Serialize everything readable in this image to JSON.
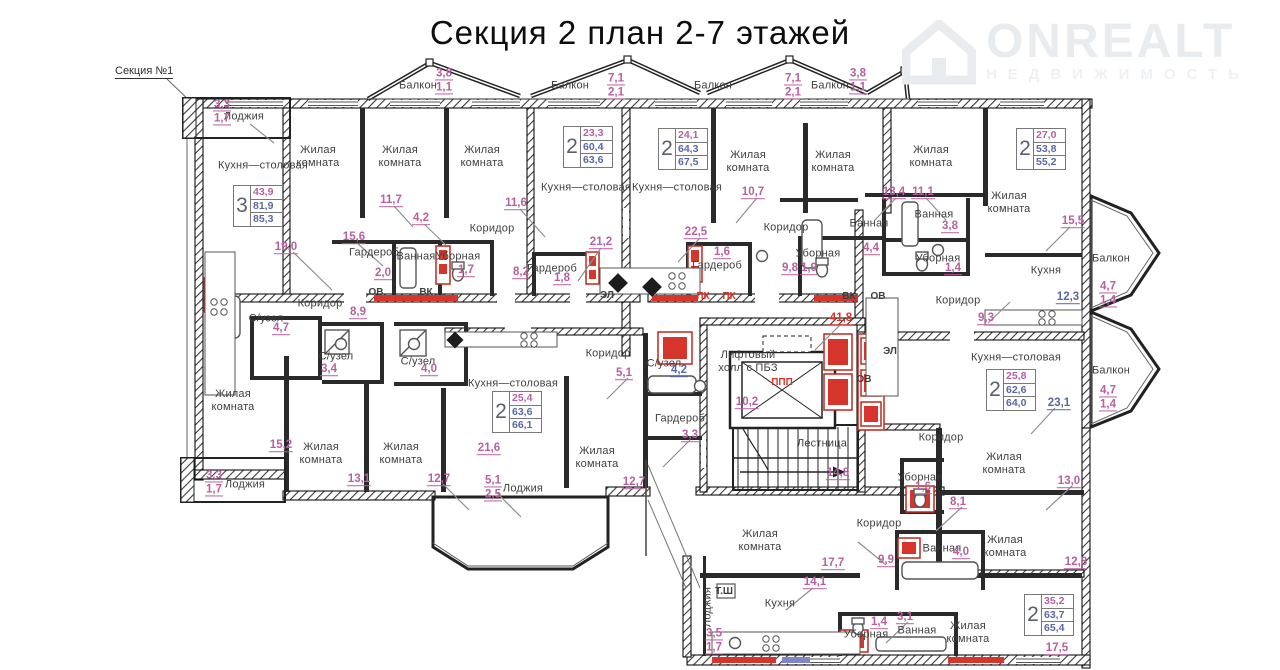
{
  "header": {
    "title": "Секция 2 план 2-7 этажей",
    "section_ref": "Секция №1",
    "logo": {
      "brand": "ONREALT",
      "subtitle": "НЕДВИЖИМОСТЬ",
      "icon": "house-icon",
      "color": "#e9ecef"
    }
  },
  "colors": {
    "area_primary": "#b8609f",
    "area_secondary": "#5868a8",
    "alert_red": "#d6352b",
    "walls": "#1a1a1a",
    "room_text": "#3f3f3f",
    "leader": "#8f8f8f"
  },
  "plan": {
    "rooms": [
      {
        "t": "Лоджия",
        "x": 244,
        "y": 117
      },
      {
        "t": "Кухня—столовая",
        "x": 263,
        "y": 166
      },
      {
        "t": "Жилая\nкомната",
        "x": 318,
        "y": 157
      },
      {
        "t": "Жилая\nкомната",
        "x": 400,
        "y": 157
      },
      {
        "t": "Жилая\nкомната",
        "x": 482,
        "y": 157
      },
      {
        "t": "Балкон",
        "x": 418,
        "y": 86
      },
      {
        "t": "Балкон",
        "x": 570,
        "y": 86
      },
      {
        "t": "Балкон",
        "x": 713,
        "y": 86
      },
      {
        "t": "Балкон",
        "x": 830,
        "y": 86
      },
      {
        "t": "Кухня—столовая",
        "x": 586,
        "y": 188
      },
      {
        "t": "Кухня—столовая",
        "x": 677,
        "y": 188
      },
      {
        "t": "Жилая\nкомната",
        "x": 748,
        "y": 162
      },
      {
        "t": "Жилая\nкомната",
        "x": 833,
        "y": 162
      },
      {
        "t": "Жилая\nкомната",
        "x": 931,
        "y": 157
      },
      {
        "t": "Жилая\nкомната",
        "x": 1009,
        "y": 203
      },
      {
        "t": "Коридор",
        "x": 492,
        "y": 229
      },
      {
        "t": "Коридор",
        "x": 786,
        "y": 228
      },
      {
        "t": "Гардероб",
        "x": 374,
        "y": 253
      },
      {
        "t": "Ванная",
        "x": 416,
        "y": 257
      },
      {
        "t": "Уборная",
        "x": 458,
        "y": 257
      },
      {
        "t": "Гардероб",
        "x": 552,
        "y": 269
      },
      {
        "t": "Гардероб",
        "x": 717,
        "y": 266
      },
      {
        "t": "Ванная",
        "x": 869,
        "y": 224
      },
      {
        "t": "Уборная",
        "x": 818,
        "y": 254
      },
      {
        "t": "Ванная",
        "x": 934,
        "y": 215
      },
      {
        "t": "Уборная",
        "x": 938,
        "y": 259
      },
      {
        "t": "Кухня",
        "x": 1046,
        "y": 271
      },
      {
        "t": "Коридор",
        "x": 958,
        "y": 301
      },
      {
        "t": "Балкон",
        "x": 1111,
        "y": 259
      },
      {
        "t": "Балкон",
        "x": 1111,
        "y": 371
      },
      {
        "t": "Коридор",
        "x": 320,
        "y": 304
      },
      {
        "t": "С/узел",
        "x": 266,
        "y": 319
      },
      {
        "t": "С/узел",
        "x": 336,
        "y": 357
      },
      {
        "t": "С/узел",
        "x": 418,
        "y": 362
      },
      {
        "t": "Жилая\nкомната",
        "x": 233,
        "y": 401
      },
      {
        "t": "Жилая\nкомната",
        "x": 321,
        "y": 454
      },
      {
        "t": "Жилая\nкомната",
        "x": 401,
        "y": 454
      },
      {
        "t": "Лоджия",
        "x": 245,
        "y": 485
      },
      {
        "t": "Кухня—столовая",
        "x": 513,
        "y": 384
      },
      {
        "t": "Жилая\nкомната",
        "x": 597,
        "y": 458
      },
      {
        "t": "Коридор",
        "x": 608,
        "y": 354
      },
      {
        "t": "С/узел",
        "x": 664,
        "y": 364
      },
      {
        "t": "Гардероб",
        "x": 680,
        "y": 419
      },
      {
        "t": "Лоджия",
        "x": 523,
        "y": 489
      },
      {
        "t": "Лифтовый\nхолл с ПБЗ",
        "x": 748,
        "y": 362
      },
      {
        "t": "Лестница",
        "x": 822,
        "y": 444
      },
      {
        "t": "Коридор",
        "x": 941,
        "y": 438
      },
      {
        "t": "Кухня—столовая",
        "x": 1016,
        "y": 358
      },
      {
        "t": "Уборная",
        "x": 920,
        "y": 478
      },
      {
        "t": "Жилая\nкомната",
        "x": 1004,
        "y": 464
      },
      {
        "t": "Жилая\nкомната",
        "x": 1005,
        "y": 547
      },
      {
        "t": "Ванная",
        "x": 942,
        "y": 549
      },
      {
        "t": "Коридор",
        "x": 879,
        "y": 524
      },
      {
        "t": "Жилая\nкомната",
        "x": 760,
        "y": 541
      },
      {
        "t": "Кухня",
        "x": 780,
        "y": 604
      },
      {
        "t": "Лоджия",
        "x": 708,
        "y": 607,
        "vert": true
      },
      {
        "t": "Уборная",
        "x": 866,
        "y": 635
      },
      {
        "t": "Ванная",
        "x": 917,
        "y": 631
      },
      {
        "t": "Жилая\nкомната",
        "x": 968,
        "y": 633
      }
    ],
    "areas": [
      {
        "v": "3,3",
        "v2": "1,7",
        "x": 222,
        "y": 112
      },
      {
        "v": "3,8",
        "v2": "1,1",
        "x": 444,
        "y": 81
      },
      {
        "v": "7,1",
        "v2": "2,1",
        "x": 616,
        "y": 86
      },
      {
        "v": "7,1",
        "v2": "2,1",
        "x": 793,
        "y": 86
      },
      {
        "v": "3,8",
        "v2": "1,1",
        "x": 858,
        "y": 81
      },
      {
        "v": "19,0",
        "x": 286,
        "y": 248
      },
      {
        "v": "15,6",
        "x": 354,
        "y": 238
      },
      {
        "v": "11,7",
        "x": 391,
        "y": 201
      },
      {
        "v": "4,2",
        "x": 421,
        "y": 219
      },
      {
        "v": "2,0",
        "x": 383,
        "y": 274
      },
      {
        "v": "1,7",
        "x": 466,
        "y": 271
      },
      {
        "v": "11,6",
        "x": 516,
        "y": 204
      },
      {
        "v": "8,2",
        "x": 521,
        "y": 273
      },
      {
        "v": "1,8",
        "x": 562,
        "y": 279
      },
      {
        "v": "21,2",
        "x": 601,
        "y": 243
      },
      {
        "v": "22,5",
        "x": 696,
        "y": 233
      },
      {
        "v": "1,6",
        "x": 722,
        "y": 253
      },
      {
        "v": "10,7",
        "x": 753,
        "y": 193
      },
      {
        "v": "13,4",
        "x": 894,
        "y": 193
      },
      {
        "v": "11,1",
        "x": 923,
        "y": 193
      },
      {
        "v": "4,4",
        "x": 871,
        "y": 249
      },
      {
        "v": "9,8",
        "x": 790,
        "y": 269
      },
      {
        "v": "1,9",
        "x": 809,
        "y": 269
      },
      {
        "v": "15,5",
        "x": 1073,
        "y": 222
      },
      {
        "v": "3,8",
        "x": 950,
        "y": 227
      },
      {
        "v": "1,4",
        "x": 953,
        "y": 269
      },
      {
        "v": "12,3",
        "c": "b",
        "x": 1068,
        "y": 298
      },
      {
        "v": "9,3",
        "x": 986,
        "y": 319
      },
      {
        "v": "4,7",
        "v2": "1,4",
        "x": 1108,
        "y": 294
      },
      {
        "v": "4,7",
        "v2": "1,4",
        "x": 1108,
        "y": 398
      },
      {
        "v": "8,9",
        "x": 358,
        "y": 313
      },
      {
        "v": "4,7",
        "x": 281,
        "y": 329
      },
      {
        "v": "3,4",
        "x": 329,
        "y": 370
      },
      {
        "v": "4,0",
        "x": 429,
        "y": 370
      },
      {
        "v": "15,2",
        "x": 281,
        "y": 446
      },
      {
        "v": "13,1",
        "x": 359,
        "y": 480
      },
      {
        "v": "12,7",
        "x": 439,
        "y": 480
      },
      {
        "v": "3,3",
        "v2": "1,7",
        "x": 214,
        "y": 483
      },
      {
        "v": "21,6",
        "x": 489,
        "y": 449
      },
      {
        "v": "5,1",
        "v2": "2,5",
        "x": 493,
        "y": 488
      },
      {
        "v": "5,1",
        "x": 624,
        "y": 374
      },
      {
        "v": "4,2",
        "c": "b",
        "x": 679,
        "y": 371
      },
      {
        "v": "3,3",
        "x": 690,
        "y": 436
      },
      {
        "v": "12,7",
        "x": 634,
        "y": 483
      },
      {
        "v": "10,2",
        "x": 747,
        "y": 403
      },
      {
        "v": "41,8",
        "c": "r",
        "x": 841,
        "y": 319
      },
      {
        "v": "14,8",
        "x": 838,
        "y": 474
      },
      {
        "v": "23,1",
        "c": "b",
        "x": 1059,
        "y": 404
      },
      {
        "v": "1,6",
        "x": 923,
        "y": 488
      },
      {
        "v": "8,1",
        "x": 958,
        "y": 503
      },
      {
        "v": "9,9",
        "x": 886,
        "y": 561
      },
      {
        "v": "4,0",
        "x": 961,
        "y": 553
      },
      {
        "v": "17,7",
        "x": 833,
        "y": 564
      },
      {
        "v": "14,1",
        "x": 815,
        "y": 583
      },
      {
        "v": "3,5",
        "v2": "1,7",
        "x": 714,
        "y": 641
      },
      {
        "v": "1,4",
        "x": 879,
        "y": 623
      },
      {
        "v": "3,1",
        "x": 905,
        "y": 618
      },
      {
        "v": "13,0",
        "x": 1069,
        "y": 482
      },
      {
        "v": "12,8",
        "x": 1076,
        "y": 563
      },
      {
        "v": "17,5",
        "x": 1057,
        "y": 649
      }
    ],
    "ducts": [
      {
        "t": "ОВ",
        "x": 376,
        "y": 293
      },
      {
        "t": "ВК",
        "x": 426,
        "y": 293
      },
      {
        "t": "ЭЛ",
        "x": 607,
        "y": 296
      },
      {
        "t": "ПК",
        "c": "r",
        "x": 703,
        "y": 297
      },
      {
        "t": "ПК",
        "c": "r",
        "x": 729,
        "y": 297
      },
      {
        "t": "ВК",
        "x": 849,
        "y": 297
      },
      {
        "t": "ОВ",
        "x": 878,
        "y": 297
      },
      {
        "t": "ОВ",
        "x": 864,
        "y": 380
      },
      {
        "t": "ЭЛ",
        "x": 890,
        "y": 352
      },
      {
        "t": "ППП",
        "c": "r",
        "x": 782,
        "y": 383
      },
      {
        "t": "Т.Ш",
        "x": 724,
        "y": 592
      }
    ],
    "apartment_tables": [
      {
        "x": 233,
        "y": 185,
        "rooms": "3",
        "r1": "43,9",
        "r2": "81,9",
        "r3": "85,3"
      },
      {
        "x": 563,
        "y": 126,
        "rooms": "2",
        "r1": "23,3",
        "r2": "60,4",
        "r3": "63,6"
      },
      {
        "x": 658,
        "y": 128,
        "rooms": "2",
        "r1": "24,1",
        "r2": "64,3",
        "r3": "67,5"
      },
      {
        "x": 1016,
        "y": 128,
        "rooms": "2",
        "r1": "27,0",
        "r2": "53,8",
        "r3": "55,2"
      },
      {
        "x": 986,
        "y": 369,
        "rooms": "2",
        "r1": "25,8",
        "r2": "62,6",
        "r3": "64,0"
      },
      {
        "x": 492,
        "y": 391,
        "rooms": "2",
        "r1": "25,4",
        "r2": "63,6",
        "r3": "66,1"
      },
      {
        "x": 1024,
        "y": 594,
        "rooms": "2",
        "r1": "35,2",
        "r2": "63,7",
        "r3": "65,4"
      }
    ]
  }
}
